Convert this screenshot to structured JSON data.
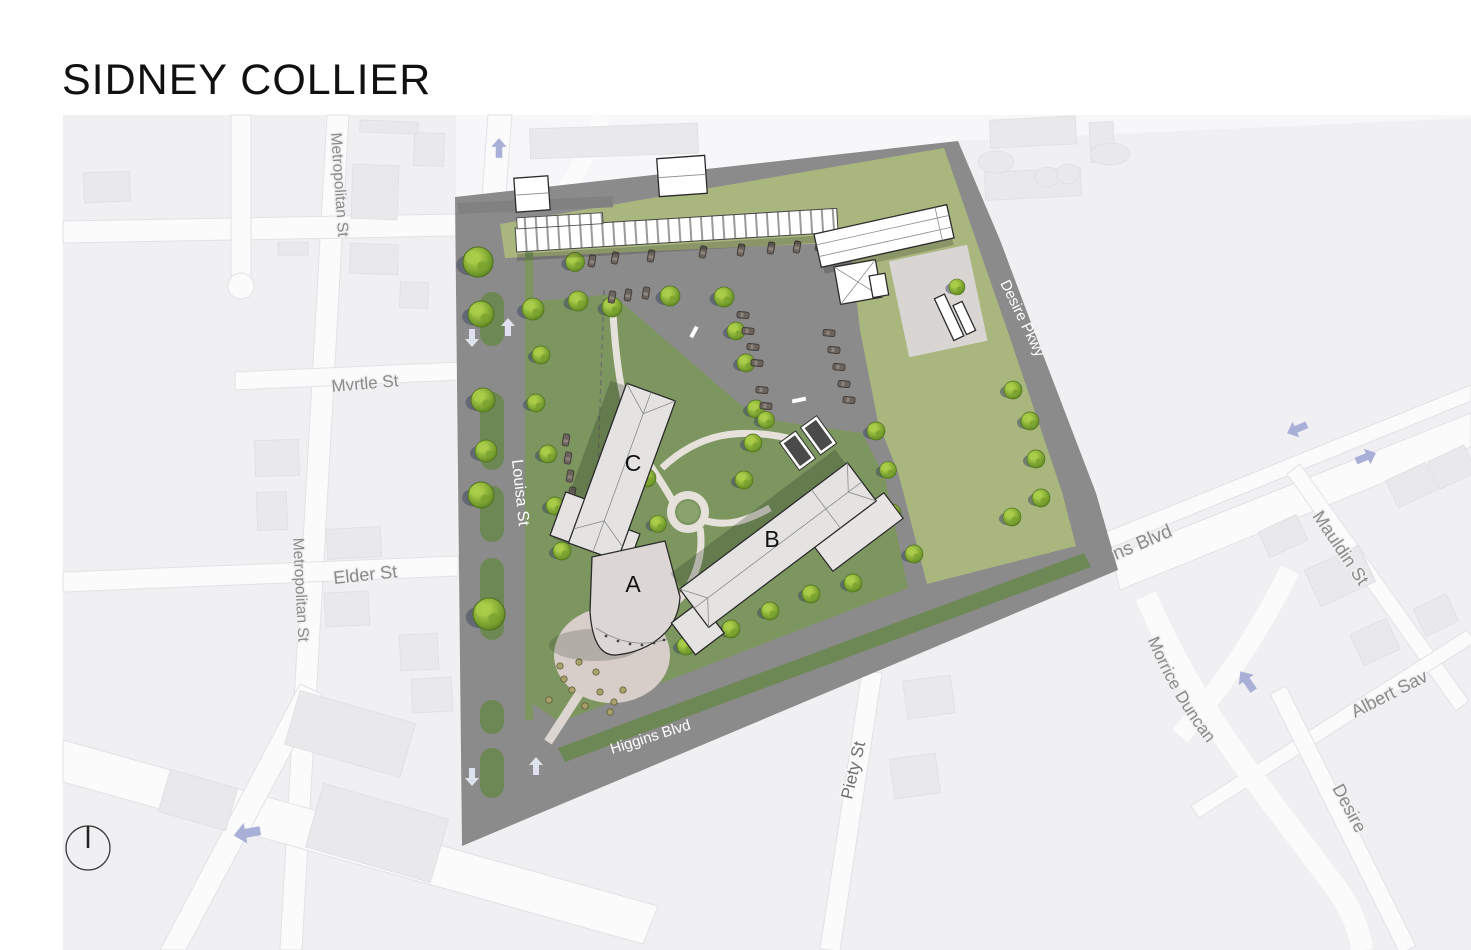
{
  "title": "SIDNEY COLLIER",
  "site": {
    "building_labels": {
      "a": "A",
      "b": "B",
      "c": "C"
    },
    "street_labels": {
      "louisa": "Louisa St",
      "higgins": "Higgins Blvd",
      "desire_pkwy": "Desire Pkwy"
    },
    "trees": [
      [
        478,
        262,
        1.5
      ],
      [
        481,
        314,
        1.3
      ],
      [
        483,
        400,
        1.2
      ],
      [
        486,
        451,
        1.1
      ],
      [
        481,
        495,
        1.3
      ],
      [
        489,
        614,
        1.6
      ],
      [
        533,
        309,
        1.1
      ],
      [
        578,
        301,
        1.0
      ],
      [
        541,
        355,
        0.9
      ],
      [
        536,
        403,
        0.9
      ],
      [
        548,
        454,
        0.9
      ],
      [
        555,
        506,
        0.9
      ],
      [
        562,
        551,
        0.9
      ],
      [
        575,
        262,
        0.95
      ],
      [
        612,
        307,
        1.0
      ],
      [
        670,
        296,
        1.0
      ],
      [
        724,
        297,
        1.0
      ],
      [
        736,
        331,
        0.9
      ],
      [
        746,
        363,
        0.9
      ],
      [
        756,
        409,
        0.9
      ],
      [
        647,
        478,
        0.9
      ],
      [
        658,
        524,
        0.85
      ],
      [
        744,
        480,
        0.9
      ],
      [
        753,
        443,
        0.9
      ],
      [
        766,
        420,
        0.85
      ],
      [
        686,
        646,
        0.9
      ],
      [
        731,
        629,
        0.9
      ],
      [
        770,
        611,
        0.9
      ],
      [
        811,
        594,
        0.9
      ],
      [
        853,
        583,
        0.9
      ],
      [
        876,
        431,
        0.9
      ],
      [
        888,
        470,
        0.85
      ],
      [
        892,
        513,
        0.9
      ],
      [
        914,
        554,
        0.9
      ],
      [
        957,
        287,
        0.8
      ],
      [
        1013,
        390,
        0.9
      ],
      [
        1030,
        421,
        0.9
      ],
      [
        1036,
        459,
        0.9
      ],
      [
        1041,
        498,
        0.9
      ],
      [
        1012,
        517,
        0.9
      ]
    ],
    "cars": [
      [
        592,
        261,
        -80
      ],
      [
        615,
        258,
        -80
      ],
      [
        651,
        256,
        -80
      ],
      [
        703,
        252,
        -80
      ],
      [
        741,
        250,
        -80
      ],
      [
        771,
        248,
        -80
      ],
      [
        797,
        247,
        -80
      ],
      [
        819,
        245,
        -80
      ],
      [
        612,
        297,
        -80
      ],
      [
        628,
        295,
        -80
      ],
      [
        646,
        293,
        -80
      ],
      [
        743,
        315,
        5
      ],
      [
        748,
        331,
        5
      ],
      [
        753,
        347,
        5
      ],
      [
        757,
        363,
        5
      ],
      [
        829,
        333,
        5
      ],
      [
        834,
        350,
        5
      ],
      [
        839,
        367,
        5
      ],
      [
        844,
        384,
        5
      ],
      [
        849,
        400,
        5
      ],
      [
        762,
        390,
        5
      ],
      [
        766,
        406,
        5
      ],
      [
        566,
        440,
        -80
      ],
      [
        568,
        458,
        -80
      ],
      [
        570,
        476,
        -80
      ],
      [
        572,
        493,
        -80
      ]
    ],
    "median_segments": [
      [
        480,
        292,
        24,
        54
      ],
      [
        480,
        392,
        24,
        78
      ],
      [
        480,
        486,
        24,
        56
      ],
      [
        480,
        558,
        24,
        82
      ],
      [
        480,
        700,
        24,
        34
      ],
      [
        480,
        748,
        24,
        50
      ]
    ],
    "plaza_shrubs": [
      [
        560,
        666
      ],
      [
        572,
        690
      ],
      [
        549,
        700
      ],
      [
        585,
        706
      ],
      [
        600,
        692
      ],
      [
        614,
        702
      ],
      [
        564,
        679
      ],
      [
        596,
        672
      ],
      [
        610,
        712
      ],
      [
        579,
        662
      ],
      [
        623,
        690
      ]
    ]
  },
  "basemap": {
    "street_labels": {
      "metropolitan_upper": "Metropolitan St",
      "metropolitan_lower": "Metropolitan St",
      "myrtle": "Mvrtle St",
      "elder": "Elder St",
      "piety": "Piety St",
      "blvd_east": "ns Blvd",
      "mauldin": "Mauldin St",
      "albert": "Albert Sav",
      "morrice": "Morrice Duncan",
      "desire_south": "Desire"
    }
  },
  "icons": {
    "compass_north": "circle-with-needle",
    "site_arrow_up": "up-arrow",
    "site_arrow_down": "down-arrow",
    "map_arrow_left": "left-arrow",
    "map_arrow_up": "up-arrow",
    "map_arrow_upleft": "up-left-arrow",
    "map_arrow_right": "right-arrow"
  },
  "colors": {
    "site_road": "#8b8b8b",
    "campus_lawn": "#7d9660",
    "field_olive": "#a9b77f",
    "median_green": "#6d8854",
    "tree_green": "#8db33a",
    "building_fill": "#e4e3e2",
    "plaza": "#d7cec9",
    "basemap_bg": "#f0f0f2",
    "street_white": "#fbfbfc",
    "map_label": "#8a8a8a",
    "blue_arrow": "#a8b0d8",
    "title_color": "#111111"
  }
}
